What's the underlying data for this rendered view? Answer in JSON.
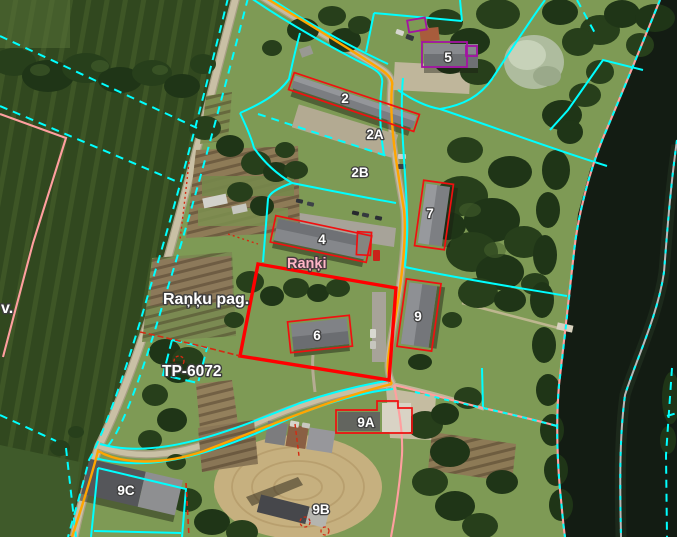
{
  "map": {
    "view": "aerial-cadastral-parcel-map",
    "labels": {
      "buildings": [
        {
          "id": "house-2",
          "text": "2"
        },
        {
          "id": "house-2a",
          "text": "2A"
        },
        {
          "id": "house-2b",
          "text": "2B"
        },
        {
          "id": "house-4",
          "text": "4"
        },
        {
          "id": "house-5",
          "text": "5"
        },
        {
          "id": "house-6",
          "text": "6"
        },
        {
          "id": "house-7",
          "text": "7"
        },
        {
          "id": "house-9",
          "text": "9"
        },
        {
          "id": "house-9a",
          "text": "9A"
        },
        {
          "id": "house-9b",
          "text": "9B"
        },
        {
          "id": "house-9c",
          "text": "9C"
        }
      ],
      "places": [
        {
          "id": "village-name",
          "text": "Raņķi",
          "color": "#ffb6c6"
        },
        {
          "id": "parish-name",
          "text": "Raņķu pag.",
          "color": "#ffffff"
        },
        {
          "id": "plan-reference",
          "text": "TP-6072",
          "color": "#ffffff"
        },
        {
          "id": "left-edge-partial",
          "text": "v.",
          "color": "#ffffff"
        }
      ]
    },
    "overlay_colors": {
      "parcel_boundary_cyan": "#00ffff",
      "selected_parcel_red": "#ff0000",
      "building_outline_red": "#f01010",
      "road_route_orange": "#ffa500",
      "shoreline_pink": "#ff9f9f",
      "river_centerline_gray": "#b8b8b8",
      "special_building_purple": "#a313a3"
    }
  }
}
